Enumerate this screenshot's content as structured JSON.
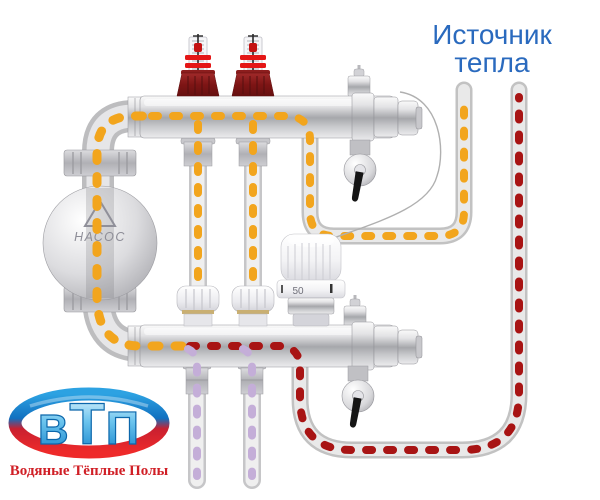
{
  "heat_source_label": {
    "line1": "Источник",
    "line2": "тепла"
  },
  "pump": {
    "label": "НАСОС"
  },
  "thermostatic_head": {
    "scale_value": "50"
  },
  "logo": {
    "letters": [
      "В",
      "Т",
      "П"
    ],
    "tagline": "Водяные Тёплые Полы"
  },
  "flow_colors": {
    "hot_supply_dash": "#a81414",
    "mixed_warm_dash": "#f2a51d",
    "cool_return_dash": "#c4aed8"
  },
  "accent_colors": {
    "heat_source_text": "#2a6abe",
    "logo_tagline_red": "#d01f26",
    "logo_letter_blue": "#1887cc",
    "flow_meter_red": "#e41616"
  }
}
